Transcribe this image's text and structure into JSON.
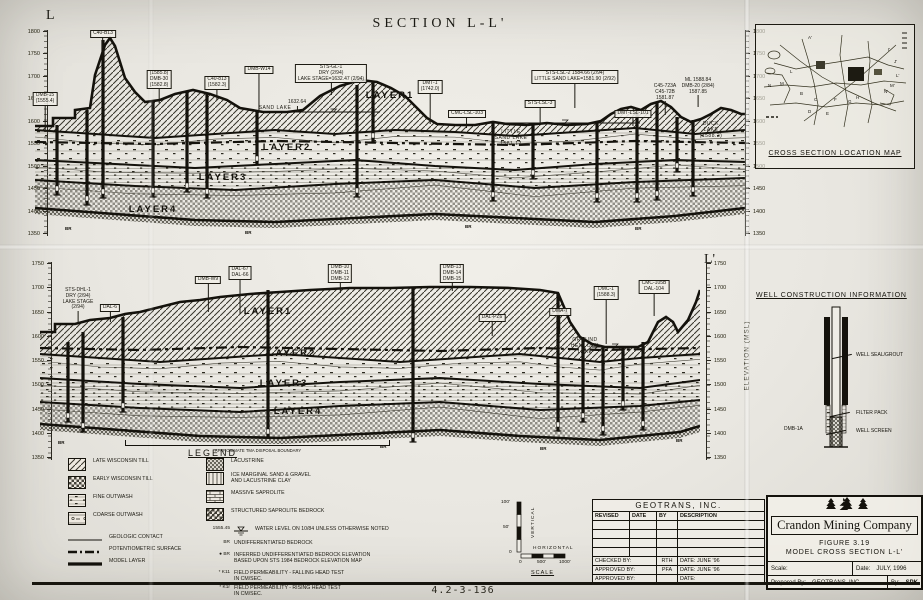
{
  "title": "SECTION L-L'",
  "doc_number": "4.2-3-136",
  "section_top": {
    "start_label": "L",
    "ticks": [
      1800,
      1750,
      1700,
      1650,
      1600,
      1550,
      1500,
      1450,
      1400,
      1350
    ],
    "layers": [
      "LAYER1",
      "LAYER2",
      "LAYER3",
      "LAYER4"
    ],
    "br_label": "BR",
    "annotations": [
      {
        "x": 10,
        "top": 62,
        "lines": [
          "DMB-15",
          "(1555.4)"
        ],
        "boxed": true,
        "leader": 26
      },
      {
        "x": 68,
        "top": 0,
        "lines": [
          "C40-B13"
        ],
        "boxed": true,
        "leader": 10
      },
      {
        "x": 124,
        "top": 40,
        "lines": [
          "(1585.8)",
          "DMB-30",
          "(1582.8)"
        ],
        "boxed": true,
        "leader": 14
      },
      {
        "x": 182,
        "top": 46,
        "lines": [
          "C40-813",
          "(1582.3)"
        ],
        "boxed": true,
        "leader": 10
      },
      {
        "x": 224,
        "top": 36,
        "lines": [
          "DMB-W14"
        ],
        "boxed": true,
        "leader": 38
      },
      {
        "x": 262,
        "top": 70,
        "lines": [
          "1632.64"
        ],
        "boxed": false,
        "leader": 6
      },
      {
        "x": 296,
        "top": 34,
        "lines": [
          "STS-GL-1",
          "DRY (2/94)",
          "LAKE STAGE=1632.47 (2/94)"
        ],
        "boxed": true,
        "leader": 12
      },
      {
        "x": 240,
        "top": 76,
        "lines": [
          "SAND  LAKE"
        ],
        "inline": true
      },
      {
        "x": 395,
        "top": 50,
        "lines": [
          "DMT-1",
          "(1742.0)"
        ],
        "boxed": true,
        "leader": 30
      },
      {
        "x": 432,
        "top": 80,
        "lines": [
          "CMC-LSL-103"
        ],
        "boxed": true,
        "leader": 10
      },
      {
        "x": 540,
        "top": 40,
        "lines": [
          "STS-LSL-2  1584.66 (2/94)",
          "LITTLE SAND LAKE=1581.90 (2/92)"
        ],
        "boxed": true,
        "leader": 24
      },
      {
        "x": 505,
        "top": 70,
        "lines": [
          "STS-LSL-3"
        ],
        "boxed": true,
        "leader": 16
      },
      {
        "x": 476,
        "top": 100,
        "lines": [
          "LITTLE",
          "SAND LAKE",
          "1581.12"
        ],
        "inline": true
      },
      {
        "x": 598,
        "top": 80,
        "lines": [
          "DMT-LSL-101"
        ],
        "boxed": true,
        "leader": 8
      },
      {
        "x": 630,
        "top": 54,
        "lines": [
          "C45-723A",
          "C45-72B",
          "1581.87"
        ],
        "boxed": false,
        "leader": 14
      },
      {
        "x": 663,
        "top": 48,
        "lines": [
          "ML  1588.84",
          "DMB-20 (2/84)",
          "1587.85"
        ],
        "boxed": false,
        "leader": 12
      },
      {
        "x": 676,
        "top": 92,
        "lines": [
          "DUCK",
          "LAKE",
          "(1588.2)"
        ],
        "inline": true
      }
    ]
  },
  "section_bottom": {
    "end_label": "L'",
    "elevation_axis": "ELEVATION (MSL)",
    "ticks": [
      1750,
      1700,
      1650,
      1600,
      1550,
      1500,
      1450,
      1400,
      1350
    ],
    "layers": [
      "LAYER1",
      "LAYER2",
      "LAYER3",
      "LAYER4"
    ],
    "br_label": "BR",
    "bracket_label": "APPROXIMATE TMA DISPOSAL BOUNDARY",
    "annotations": [
      {
        "x": 38,
        "top": 26,
        "lines": [
          "STS-DHL-1",
          "DRY (2/94)",
          "LAKE STAGE",
          "(2/94)"
        ],
        "boxed": false,
        "leader": 12
      },
      {
        "x": 70,
        "top": 42,
        "lines": [
          "DAL-6"
        ],
        "boxed": true,
        "leader": 10
      },
      {
        "x": 168,
        "top": 14,
        "lines": [
          "DMB-W9"
        ],
        "boxed": true,
        "leader": 28
      },
      {
        "x": 200,
        "top": 4,
        "lines": [
          "DAL-67",
          "DAL-66"
        ],
        "boxed": true,
        "leader": 34
      },
      {
        "x": 300,
        "top": 2,
        "lines": [
          "DMB-10",
          "DMB-11",
          "DMB-12"
        ],
        "boxed": true,
        "leader": 10
      },
      {
        "x": 412,
        "top": 2,
        "lines": [
          "DMB-13",
          "DMB-14",
          "DMB-15"
        ],
        "boxed": true,
        "leader": 8
      },
      {
        "x": 614,
        "top": 18,
        "lines": [
          "CMC-105B",
          "DAL-104"
        ],
        "boxed": true,
        "leader": 22
      },
      {
        "x": 452,
        "top": 52,
        "lines": [
          "DAL-PZ6"
        ],
        "boxed": true,
        "leader": 14
      },
      {
        "x": 520,
        "top": 46,
        "lines": [
          "DMA-7"
        ],
        "boxed": true,
        "leader": 18
      },
      {
        "x": 566,
        "top": 24,
        "lines": [
          "DMC-1",
          "(1588.3)"
        ],
        "boxed": true,
        "leader": 44
      },
      {
        "x": 545,
        "top": 76,
        "lines": [
          "GROUND",
          "HEMLOCK",
          "LAKE"
        ],
        "inline": true
      }
    ]
  },
  "location_map": {
    "title": "CROSS SECTION LOCATION MAP",
    "letters": [
      "A'",
      "I'",
      "J'",
      "L'",
      "M'",
      "N'",
      "L",
      "M",
      "N",
      "B",
      "C",
      "D",
      "E",
      "F",
      "G",
      "H"
    ]
  },
  "well_construction": {
    "title": "WELL CONSTRUCTION INFORMATION",
    "well_name": "DMB-1A",
    "labels": [
      "WELL SEAL/GROUT",
      "FILTER PACK",
      "WELL SCREEN"
    ]
  },
  "legend": {
    "title": "LEGEND",
    "left_items": [
      {
        "swatch": "hatch",
        "label": "LATE WISCONSIN TILL"
      },
      {
        "swatch": "check",
        "label": "EARLY WISCONSIN TILL"
      },
      {
        "swatch": "fine",
        "label": "FINE OUTWASH"
      },
      {
        "swatch": "coarse",
        "label": "COARSE OUTWASH"
      },
      {
        "swatch": "line-thin",
        "label": "GEOLOGIC CONTACT"
      },
      {
        "swatch": "line-dashdot",
        "label": "POTENTIOMETRIC SURFACE"
      },
      {
        "swatch": "line-thick",
        "label": "MODEL LAYER"
      }
    ],
    "right_items": [
      {
        "swatch": "lacustrine",
        "label": "LACUSTRINE"
      },
      {
        "swatch": "icemarg",
        "label": "ICE MARGINAL SAND & GRAVEL",
        "label2": "AND LACUSTRINE CLAY"
      },
      {
        "swatch": "massive",
        "label": "MASSIVE SAPROLITE"
      },
      {
        "swatch": "struct",
        "label": "STRUCTURED SAPROLITE BEDROCK"
      },
      {
        "swatch": "waterlevel",
        "prefix": "1555.45",
        "label": "WATER LEVEL ON 10/84 UNLESS OTHERWISE NOTED"
      },
      {
        "swatch": "none",
        "prefix": "BR",
        "label": "UNDIFFERENTIATED BEDROCK"
      },
      {
        "swatch": "none",
        "prefix": "● BR",
        "label": "INFERRED UNDIFFERENTIATED BEDROCK ELEVATION",
        "label2": "BASED UPON STS 1984 BEDROCK ELEVATION MAP"
      },
      {
        "swatch": "none",
        "prefix": "* K11",
        "label": "FIELD PERMEABILITY - FALLING HEAD TEST",
        "label2": "IN CM/SEC."
      },
      {
        "swatch": "none",
        "prefix": "* K1r",
        "label": "FIELD PERMEABILITY - RISING HEAD TEST",
        "label2": "IN CM/SEC."
      }
    ]
  },
  "scale": {
    "vertical": "VERTICAL",
    "horizontal": "HORIZONTAL",
    "title": "SCALE",
    "v_ticks": [
      "100'",
      "50'",
      "0"
    ],
    "h_ticks": [
      "0",
      "500'",
      "1000'"
    ]
  },
  "title_block": {
    "company": "GEOTRANS, INC.",
    "cols": [
      "REVISED",
      "DATE",
      "BY",
      "DESCRIPTION"
    ],
    "sign_rows": [
      [
        "CHECKED BY:",
        "RTH",
        "DATE: JUNE '96"
      ],
      [
        "APPROVED BY:",
        "PFA",
        "DATE: JUNE '96"
      ],
      [
        "APPROVED BY:",
        "",
        "DATE:"
      ]
    ],
    "client": "Crandon Mining Company",
    "figure_no": "FIGURE 3.19",
    "figure_title": "MODEL CROSS SECTION L-L'",
    "scale_label": "Scale:",
    "date_label": "Date:",
    "date_value": "JULY, 1996",
    "prepared_label": "Prepared By:",
    "prepared_value": "GEOTRANS, INC.",
    "by_label": "By:",
    "by_value": "SPK"
  }
}
